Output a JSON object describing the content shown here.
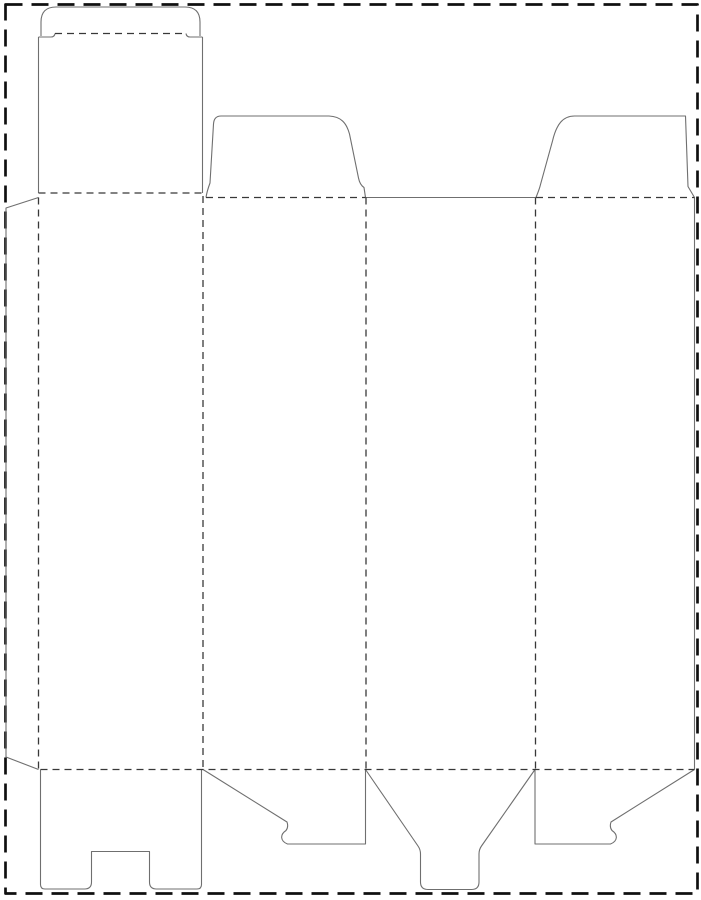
{
  "canvas": {
    "width": 701,
    "height": 900,
    "background": "#ffffff"
  },
  "diagram": {
    "kind": "box-dieline-template",
    "description": "Die-cut template for a tuck-top snap-lock-bottom carton: rounded tuck flap, lid panel, four body panels, two dust flaps, glue flap, and bottom closure flaps"
  },
  "styles": {
    "cut": {
      "color": "#6f6f6f",
      "width": 1.1,
      "dash": ""
    },
    "fold": {
      "color": "#383838",
      "width": 1.3,
      "dash": "7 5"
    },
    "border": {
      "color": "#101010",
      "width": 2.7,
      "dash": "17 9"
    }
  },
  "border": {
    "x": 5.5,
    "y": 4.5,
    "width": 692,
    "height": 889
  },
  "cut_paths": [
    {
      "name": "tuck-flap-outline",
      "d": "M 41,36 L 41,22 Q 41,7 56,7 L 185,7 Q 200,7 200,22 L 200,36"
    },
    {
      "name": "tuck-left-shoulder",
      "d": "M 38.5,37 L 51,37 Q 54.5,37 55,33.5"
    },
    {
      "name": "tuck-right-shoulder",
      "d": "M 186,33.5 Q 186.5,37 190,37 L 202.5,37"
    },
    {
      "name": "lid-left-edge",
      "d": "M 38.5,37 L 38.5,193"
    },
    {
      "name": "lid-right-edge",
      "d": "M 202.5,37 L 202.5,193"
    },
    {
      "name": "glue-flap-outline",
      "d": "M 38.5,197.5 L 6,208 L 6,757 L 38.5,769.5"
    },
    {
      "name": "dust-flap-left",
      "d": "M 206,197.5 C 207,191 208.5,187 210,183 L 213.5,124 Q 214,116 221,116 L 329,116 C 341,116.5 346.5,123 349.5,134 L 358.5,178 C 359.5,183 361,185.5 364,187.5 L 365.5,197.5"
    },
    {
      "name": "back-panel-top-edge",
      "d": "M 365.5,197.5 L 535.5,197.5"
    },
    {
      "name": "dust-flap-right",
      "d": "M 536,197.5 C 537.5,193.5 539.5,189 540.5,184.5 L 552.5,141 C 556.5,124 563,116 574.5,116 L 685.5,116 L 688,186.5 L 694.5,197.5"
    },
    {
      "name": "right-side-edge",
      "d": "M 694.5,197.5 L 694.5,769.5"
    },
    {
      "name": "bottom-lock-flap",
      "d": "M 40.5,769.5 L 40.5,884.5 Q 40.5,889 45,889 L 84.5,889 Q 91.5,889 91.5,882 L 91.5,851.5 L 149.5,851.5 L 149.5,882 Q 149.5,889 156.5,889 L 197,889 Q 201.5,889 201.5,884.5 L 201.5,769.5"
    },
    {
      "name": "bottom-hook-flap-left",
      "d": "M 203,769.5 L 287,822 C 288,825 288,828 286,830.5 C 280,834.5 280,841 287.5,844 L 365.5,844 L 365.5,769.5"
    },
    {
      "name": "bottom-tongue-flap",
      "d": "M 365.5,769.5 L 418,846 Q 420.5,849.5 420.5,854 L 420.5,882 Q 420.5,889.5 428,889.5 L 471.5,889.5 Q 479,889.5 479,882 L 479,854 Q 479,849.5 481.5,846 L 535,769.5"
    },
    {
      "name": "bottom-hook-flap-right",
      "d": "M 535,769.5 L 535,844 L 610.5,844 C 618,841 618,834.5 612,830.5 C 610,828 610,825 611,822 L 694.5,769.5"
    }
  ],
  "fold_lines": [
    {
      "name": "tuck-flap-fold",
      "d": "M 55,33.5 L 186,33.5"
    },
    {
      "name": "lid-panel-fold",
      "d": "M 38.5,193 L 202.5,193"
    },
    {
      "name": "glue-flap-fold",
      "d": "M 38.5,197.5 L 38.5,769.5"
    },
    {
      "name": "panel1-panel2-fold",
      "d": "M 203,196 L 203,769.5"
    },
    {
      "name": "panel2-panel3-fold",
      "d": "M 366,197.5 L 366,769.5"
    },
    {
      "name": "panel3-panel4-fold",
      "d": "M 535.5,197.5 L 535.5,769.5"
    },
    {
      "name": "dust-flap-left-fold",
      "d": "M 206,197.5 L 365.5,197.5"
    },
    {
      "name": "dust-flap-right-fold",
      "d": "M 536,197.5 L 694.5,197.5"
    },
    {
      "name": "bottom-flaps-fold",
      "d": "M 40.5,769.5 L 694.5,769.5"
    }
  ]
}
